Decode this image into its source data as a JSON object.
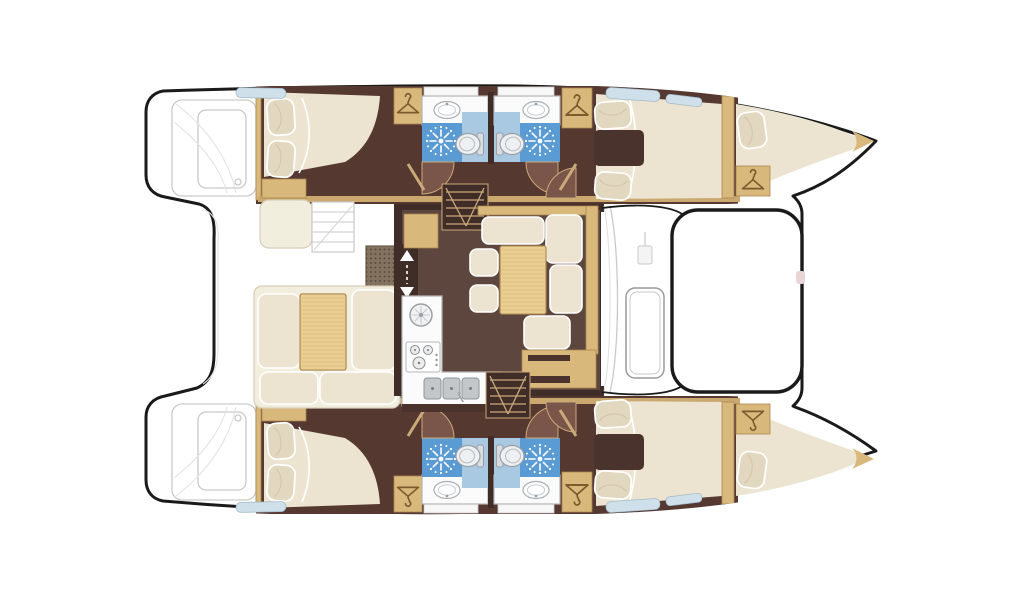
{
  "meta": {
    "title": "Catamaran sailing yacht interior layout floor plan, top-down view",
    "type": "boat-deck-plan",
    "text_visible_on_image": "none"
  },
  "palette": {
    "outline": "#1a1a1a",
    "deckLine": "#c9c9c9",
    "floorHull": "#553830",
    "floorSalon": "#5d463e",
    "wallDark": "#402d27",
    "darkUnit": "#4a332c",
    "wood": "#d9b87c",
    "woodDark": "#a8854e",
    "tableTan": "#e9cf92",
    "cream": "#ece4d0",
    "benchCream": "#f2eedd",
    "pillow": "#e2d8bf",
    "bathBlue": "#5b9bd3",
    "bathLight": "#a9c8e2",
    "hatchBlue": "#cfe0ea",
    "sinkGray": "#c3c7c9",
    "gridMat": "#83725f",
    "doorArc": "#7a564a",
    "accentPink": "#ead5d5"
  },
  "icons": [
    {
      "name": "hanger-icon",
      "meaning": "wardrobe / hanging locker"
    },
    {
      "name": "shower-icon",
      "meaning": "shower starburst"
    },
    {
      "name": "toilet-icon",
      "meaning": "marine toilet"
    },
    {
      "name": "sink-icon",
      "meaning": "washbasin"
    },
    {
      "name": "stairs-icon",
      "meaning": "companionway steps"
    },
    {
      "name": "entry-arrows-icon",
      "meaning": "salon entry direction arrows"
    },
    {
      "name": "stove-icon",
      "meaning": "galley stove burners"
    }
  ],
  "regions": {
    "port_hull": [
      "aft-cabin",
      "bathroom",
      "bathroom",
      "forward-cabin",
      "forepeak-berth"
    ],
    "starboard_hull": [
      "aft-cabin",
      "bathroom",
      "bathroom",
      "forward-cabin",
      "forepeak-berth"
    ],
    "bridgedeck": [
      "cockpit",
      "salon-dinette",
      "galley",
      "nav-desk",
      "foredeck-platform"
    ]
  }
}
